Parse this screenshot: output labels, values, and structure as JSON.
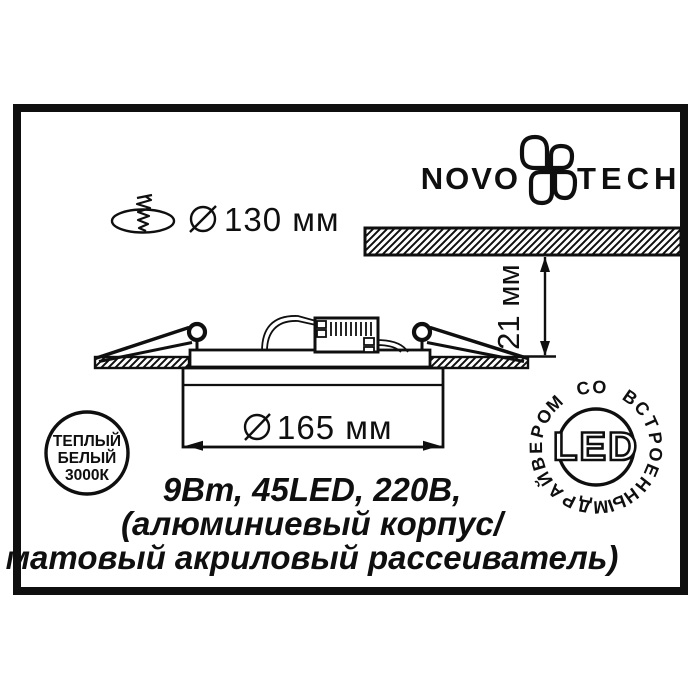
{
  "title": "Novotech recessed LED panel specification drawing",
  "colors": {
    "ink": "#0f0f0f",
    "paper": "#ffffff"
  },
  "brand": {
    "name_left": "NOVO",
    "name_right": "TECH"
  },
  "dimensions": {
    "cutout_diameter_label": "130 мм",
    "panel_diameter_label": "165 мм",
    "protrusion_label": "21 мм"
  },
  "specs_lines": {
    "line1": "9Вт, 45LED, 220В,",
    "line2": "(алюминиевый корпус/",
    "line3": "матовый акриловый рассеиватель)"
  },
  "badges": {
    "warm_white": {
      "line1": "ТЕПЛЫЙ",
      "line2": "БЕЛЫЙ",
      "line3": "3000К"
    },
    "led": {
      "center_label": "LED",
      "ring_text": "ДРАЙВЕРОМ СО ВСТРОЕННЫМ"
    }
  }
}
